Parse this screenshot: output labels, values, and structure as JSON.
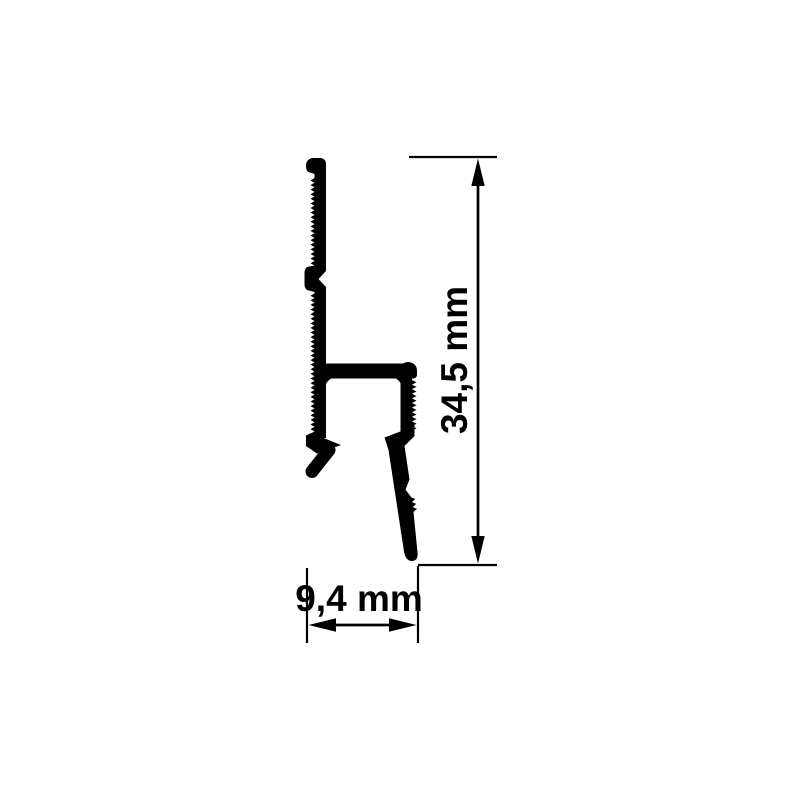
{
  "diagram": {
    "type": "technical-drawing",
    "subject": "aluminium picture rail profile cross-section",
    "dimensions": {
      "height_label": "34,5 mm",
      "width_label": "9,4 mm"
    },
    "colors": {
      "ink": "#000000",
      "background": "#ffffff"
    }
  }
}
